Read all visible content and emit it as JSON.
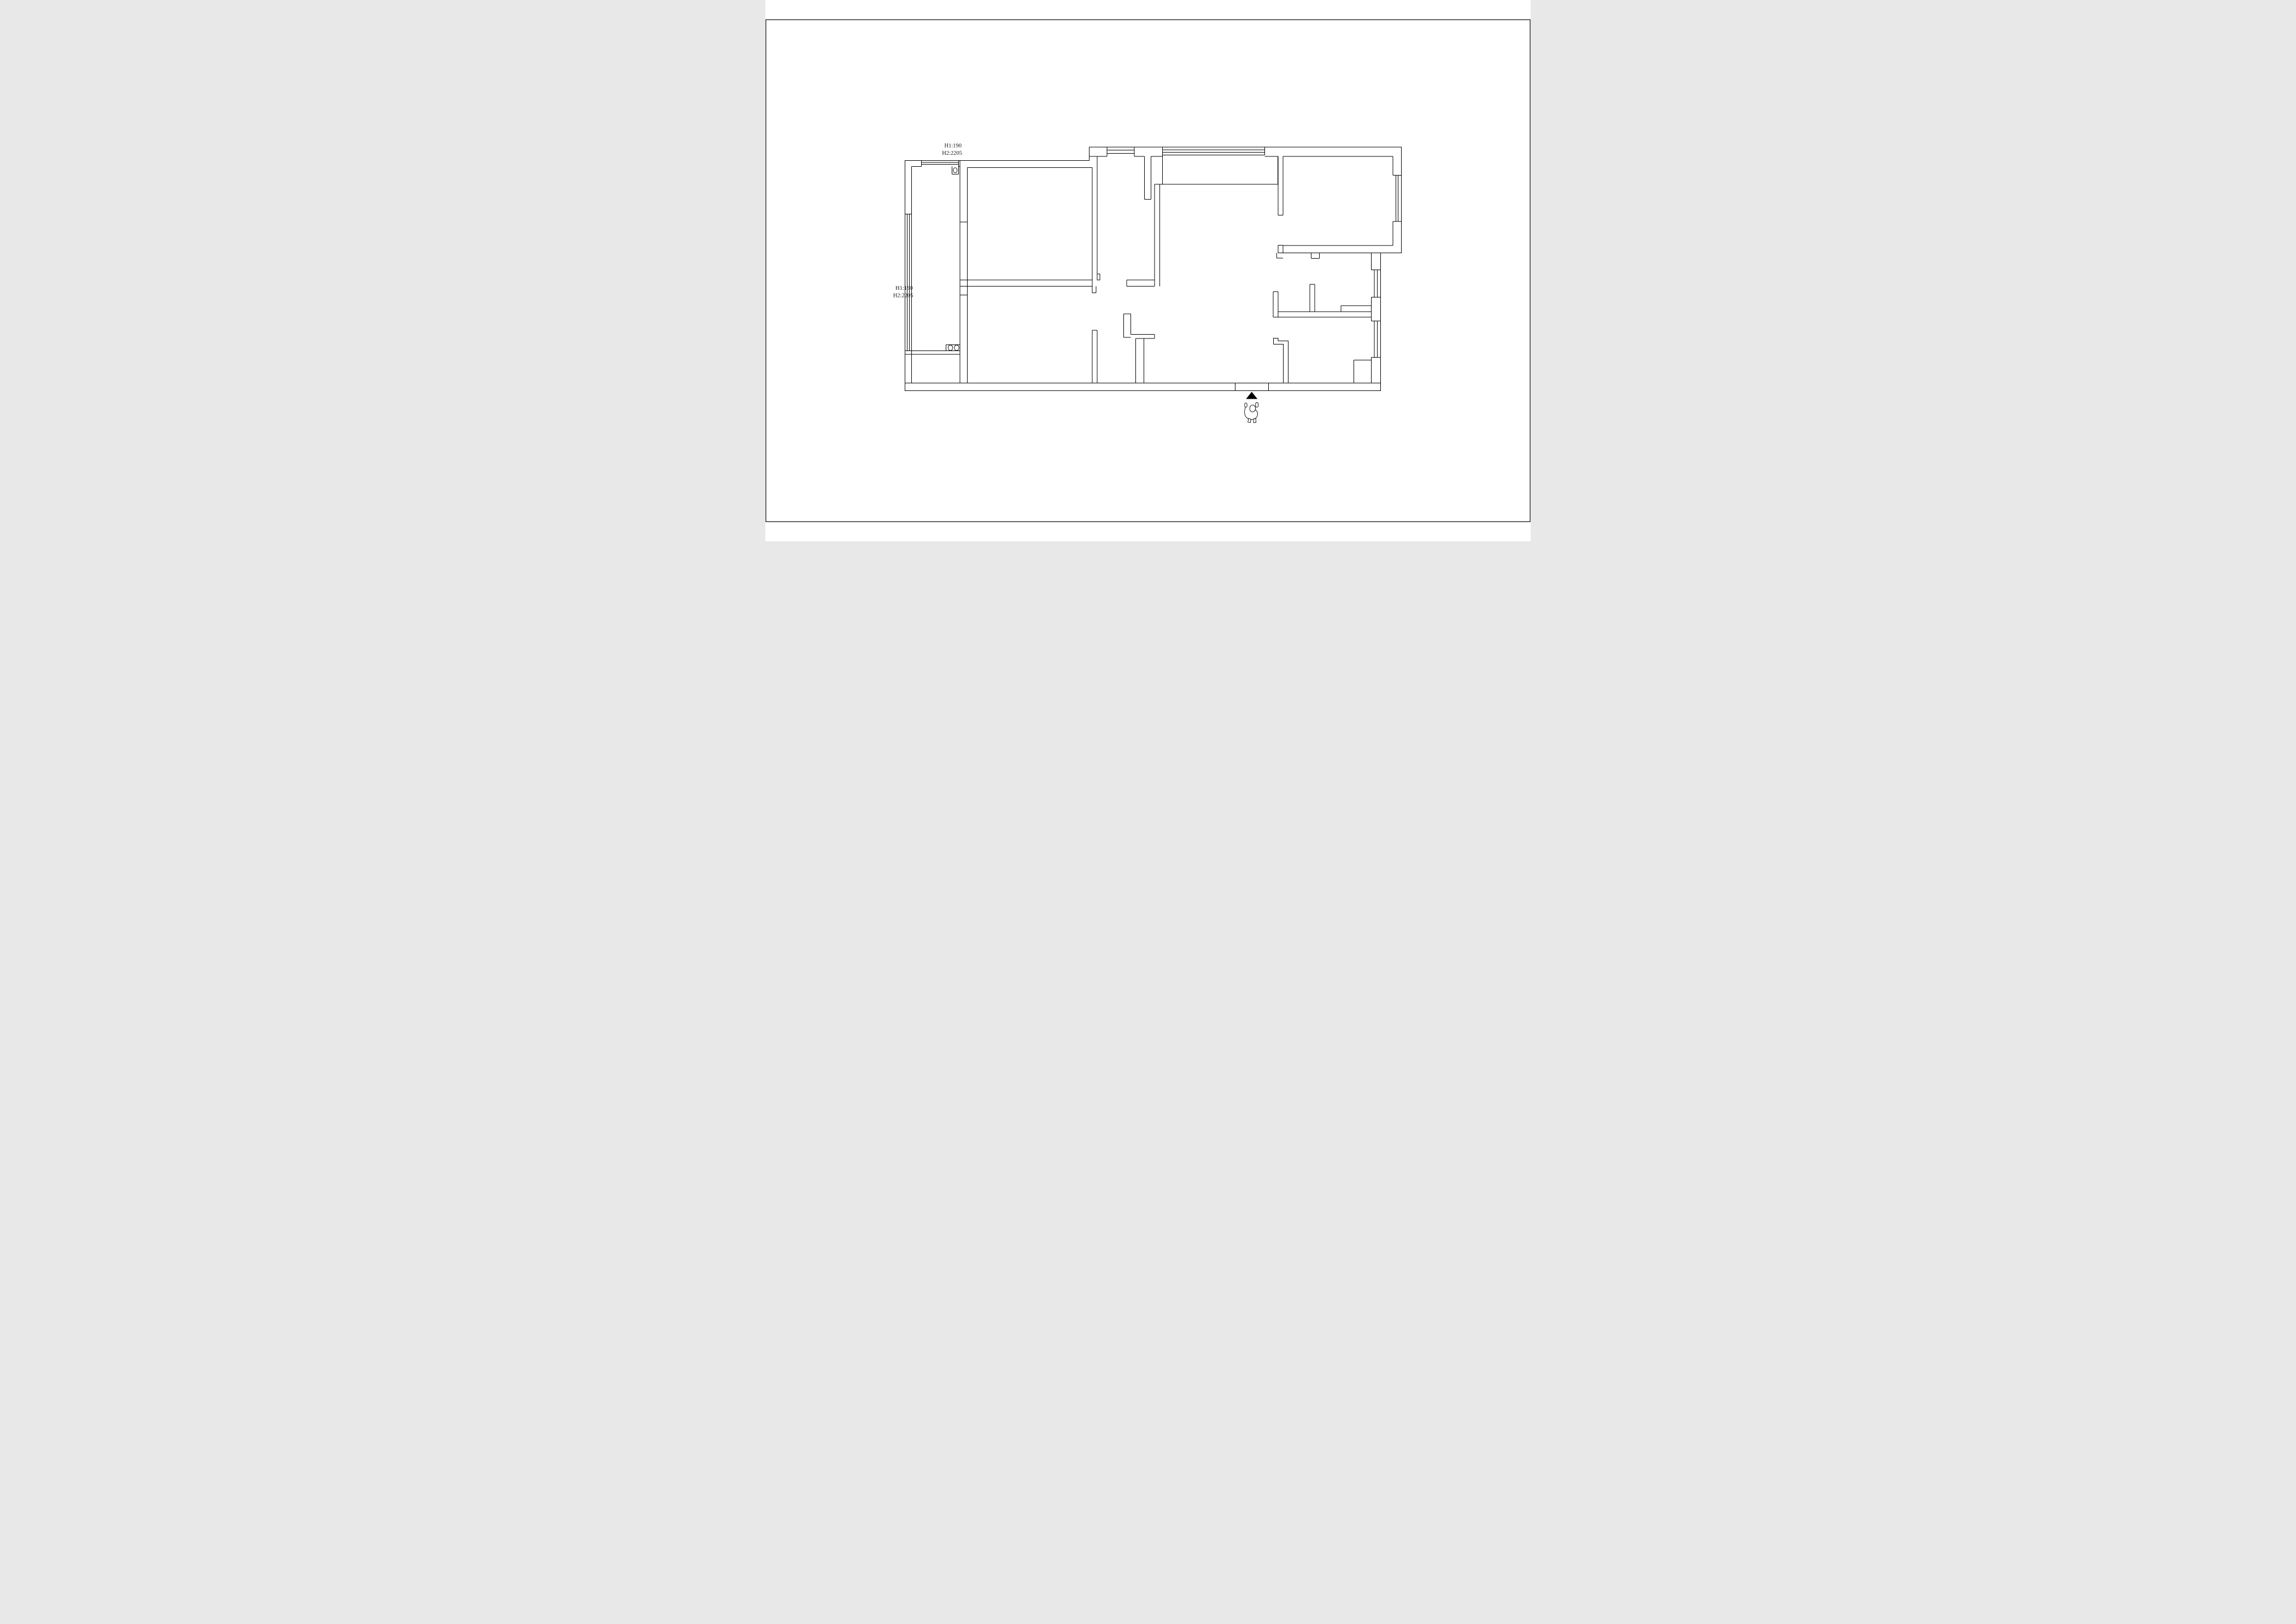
{
  "sheet": {
    "background": "#ffffff",
    "border_color": "#000000"
  },
  "drawing": {
    "line_color": "#000000",
    "marker_fill": "#000000"
  },
  "annotations": {
    "top": {
      "line1": "H1:190",
      "line2": "H2:2205"
    },
    "left": {
      "line1": "H1:190",
      "line2": "H2:2205"
    }
  },
  "symbols": {
    "entrance_marker": "entrance-triangle",
    "person": "person-top-view"
  }
}
